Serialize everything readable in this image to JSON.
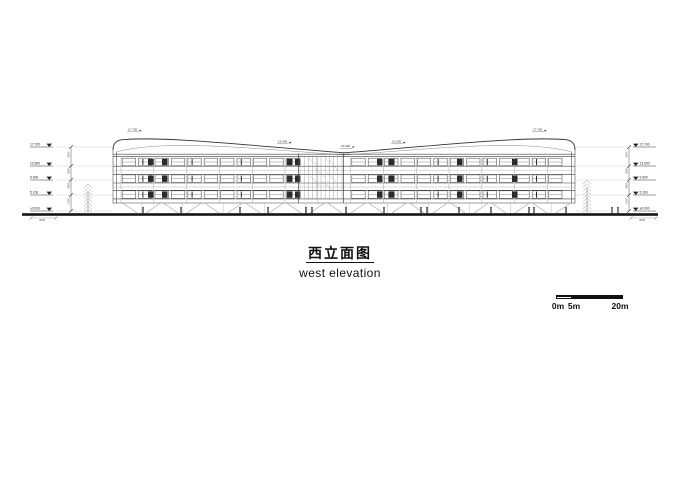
{
  "colors": {
    "ink": "#1a1a1a",
    "line": "#3f3f3f",
    "faint": "#aaaaaa",
    "leader": "#c9c9c9",
    "dim": "#555555"
  },
  "title_block": {
    "title_cn": "西立面图",
    "title_en": "west elevation"
  },
  "scale_bar": {
    "label_0": "0m",
    "label_5": "5m",
    "label_20": "20m"
  },
  "drawing": {
    "levels_left": [
      {
        "label": "17.700",
        "y": 147
      },
      {
        "label": "13.500",
        "y": 166
      },
      {
        "label": "9.900",
        "y": 180
      },
      {
        "label": "5.100",
        "y": 195
      },
      {
        "label": "±0.000",
        "y": 211
      }
    ],
    "levels_right": [
      {
        "label": "17.700",
        "y": 147
      },
      {
        "label": "13.500",
        "y": 166
      },
      {
        "label": "9.900",
        "y": 180
      },
      {
        "label": "5.100",
        "y": 195
      },
      {
        "label": "±0.000",
        "y": 211
      }
    ],
    "dims_left": [
      "4200",
      "3600",
      "4800",
      "5100"
    ],
    "dims_right": [
      "4200",
      "3600",
      "4800",
      "5100"
    ],
    "roof_annotations": [
      {
        "text": "17.700",
        "x": 128,
        "y": 130.5
      },
      {
        "text": "15.600",
        "x": 278,
        "y": 142.5
      },
      {
        "text": "15.600",
        "x": 341,
        "y": 147
      },
      {
        "text": "15.600",
        "x": 392,
        "y": 142.5
      },
      {
        "text": "17.700",
        "x": 533,
        "y": 130.5
      }
    ],
    "ground_notes": [
      {
        "text": "4500",
        "x": 43,
        "y": 221
      },
      {
        "text": "4500",
        "x": 643,
        "y": 221
      }
    ]
  }
}
